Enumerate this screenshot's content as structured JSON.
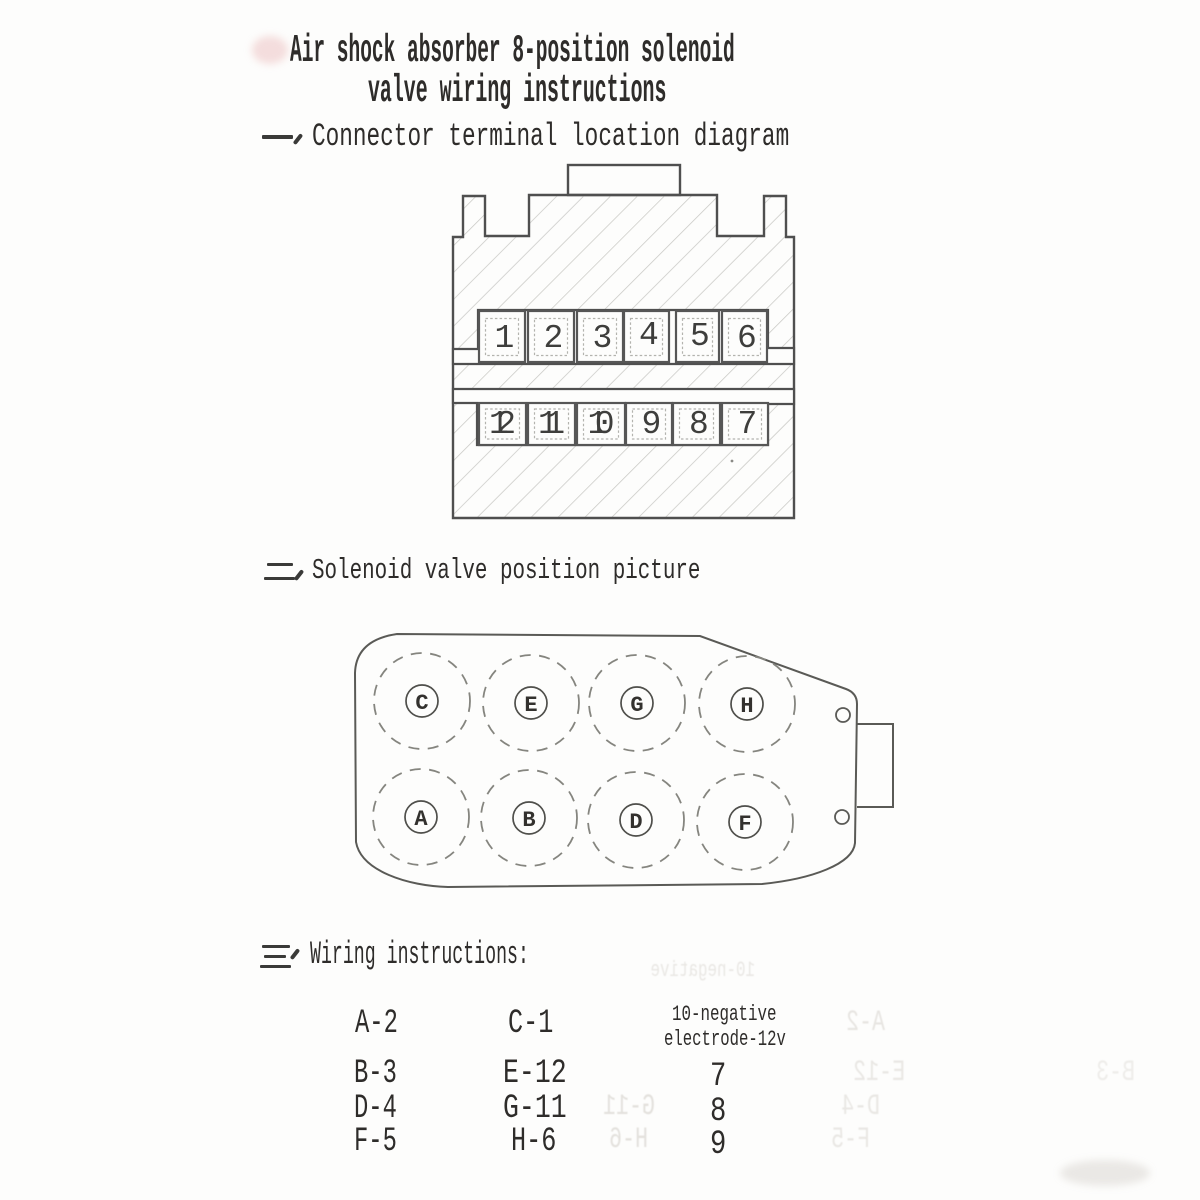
{
  "document": {
    "title_line1": "Air shock absorber 8-position solenoid",
    "title_line2": "valve wiring instructions"
  },
  "sections": {
    "one": {
      "marker": "一、",
      "label": "Connector terminal location diagram"
    },
    "two": {
      "marker": "二、",
      "label": "Solenoid valve position picture"
    },
    "three": {
      "marker": "三、",
      "label": "Wiring instructions:"
    }
  },
  "connector": {
    "top_terminals": [
      "1",
      "2",
      "3",
      "4",
      "5",
      "6"
    ],
    "bottom_terminals": [
      "12",
      "11",
      "10",
      "9",
      "8",
      "7"
    ]
  },
  "valve": {
    "top_row": [
      "C",
      "E",
      "G",
      "H"
    ],
    "bottom_row": [
      "A",
      "B",
      "D",
      "F"
    ]
  },
  "wiring": {
    "col1": [
      "A-2",
      "B-3",
      "D-4",
      "F-5"
    ],
    "col2": [
      "C-1",
      "E-12",
      "G-11",
      "H-6"
    ],
    "negative_note_line1": "10-negative",
    "negative_note_line2": "electrode-12v",
    "col3": [
      "7",
      "8",
      "9"
    ]
  },
  "ghosts": [
    {
      "text": "10-negative"
    },
    {
      "text": "A-2"
    },
    {
      "text": "E-12"
    },
    {
      "text": "G-11"
    },
    {
      "text": "D-4"
    },
    {
      "text": "H-6"
    },
    {
      "text": "F-5"
    },
    {
      "text": "B-3"
    }
  ],
  "colors": {
    "paper": "#fdfdfc",
    "ink": "#2e2c2a",
    "line": "#4f4f4f",
    "hatch": "#c9c9c5",
    "ghost": "#9a9184"
  }
}
